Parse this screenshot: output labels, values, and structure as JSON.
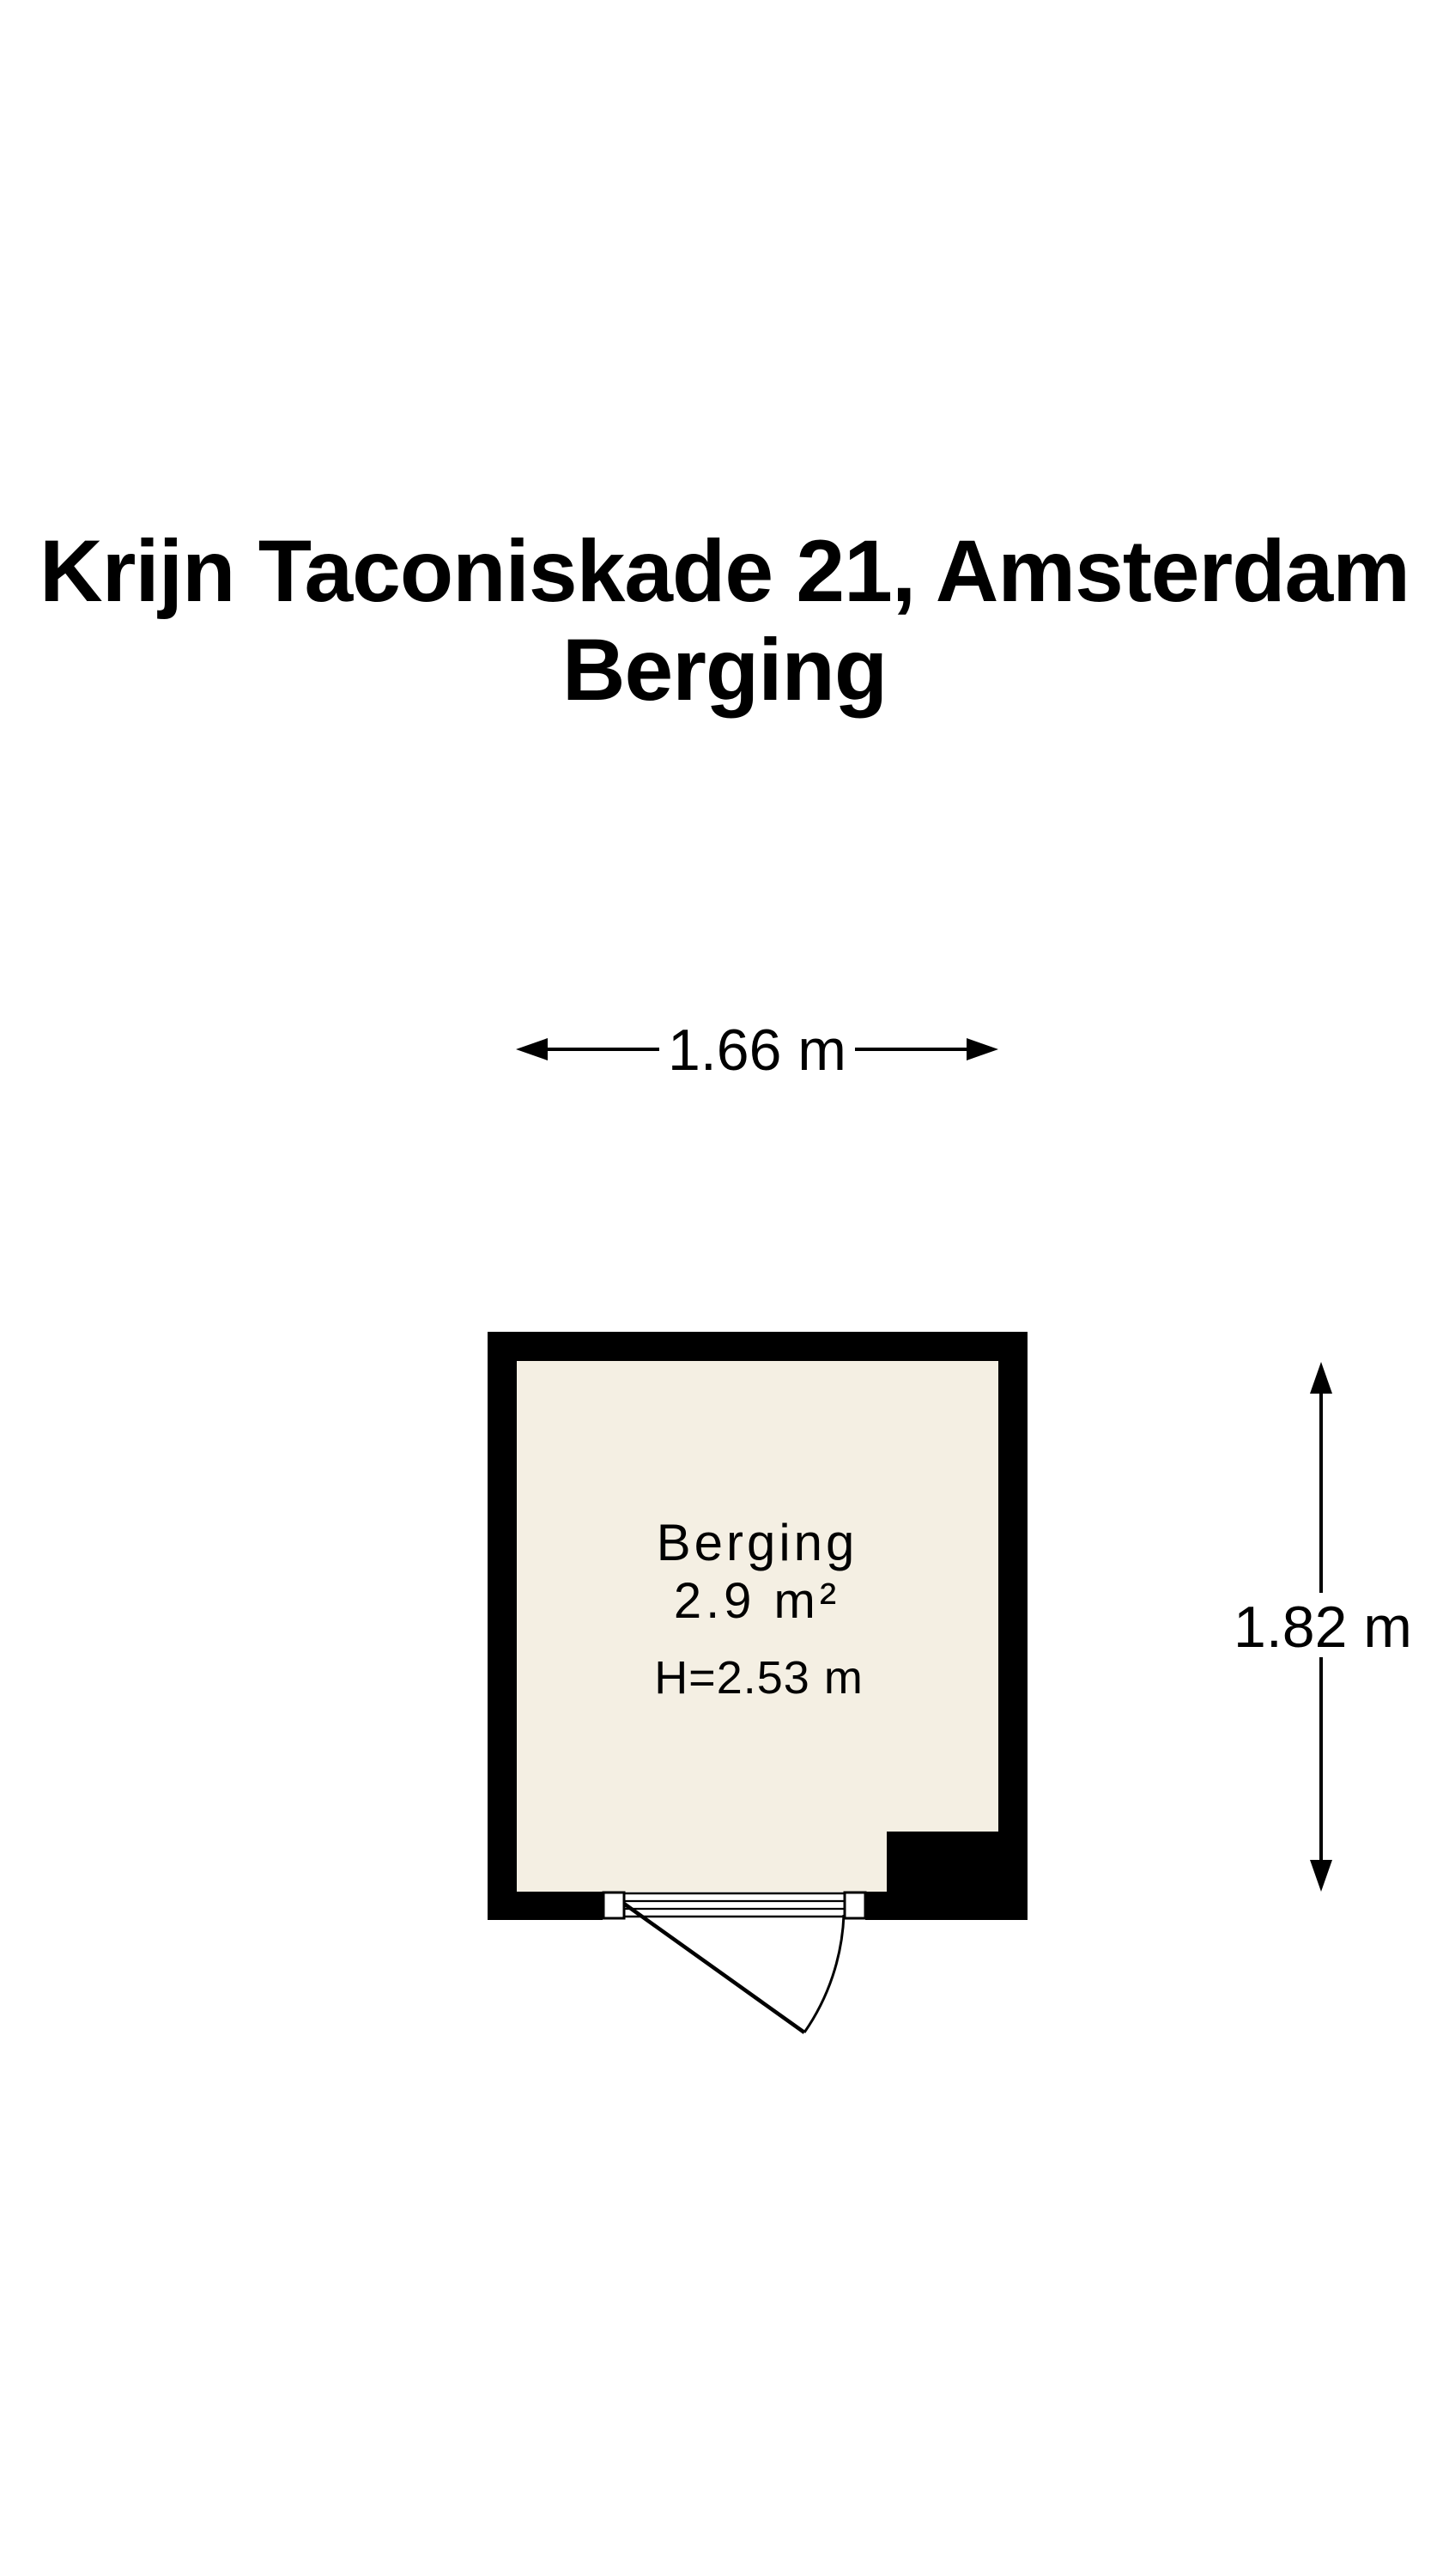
{
  "title": {
    "line1": "Krijn Taconiskade 21, Amsterdam",
    "line2": "Berging"
  },
  "floor_plan": {
    "room_label": {
      "name": "Berging",
      "area": "2.9 m²",
      "ceiling_height": "H=2.53 m"
    },
    "dimensions": {
      "width_label": "1.66 m",
      "height_label": "1.82 m"
    },
    "colors": {
      "wall": "#000000",
      "floor": "#f4efe3",
      "background": "#ffffff",
      "text": "#000000"
    }
  }
}
